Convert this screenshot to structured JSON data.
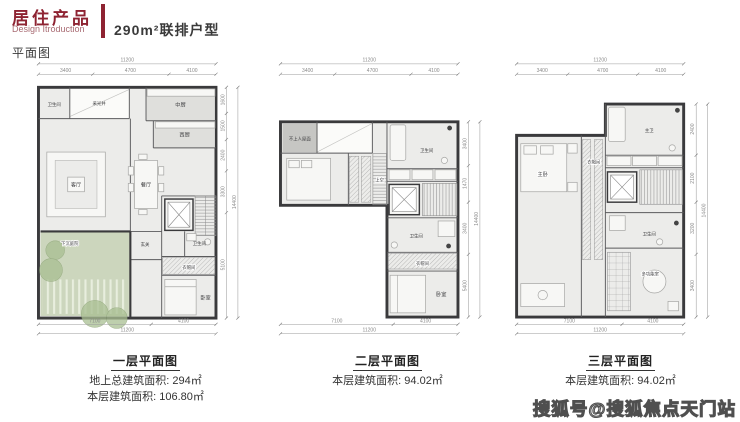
{
  "header": {
    "title_cn": "居住产品",
    "title_en": "Design Itroduction",
    "product": "290m²联排户型",
    "section": "平面图",
    "accent": "#8e2332"
  },
  "watermark": "搜狐号@搜狐焦点天门站",
  "floor1": {
    "caption": {
      "title": "一层平面图",
      "line1": "地上总建筑面积: 294㎡",
      "line2": "本层建筑面积: 106.80㎡"
    },
    "rooms": {
      "bath_top": "卫生间",
      "lightwell": "采光井",
      "kitchen_cn": "中厨",
      "kitchen_west": "西厨",
      "living": "客厅",
      "dining": "餐厅",
      "courtyard": "下沉庭院",
      "foyer": "玄关",
      "bath": "卫生间",
      "cloak": "衣帽间",
      "bedroom": "卧室"
    },
    "dims": {
      "top": {
        "total": "11200",
        "segs": [
          "3400",
          "4700",
          "4100"
        ]
      },
      "bottom": {
        "total": "11200",
        "segs": [
          "7100",
          "4100"
        ]
      },
      "right": {
        "total": "14400",
        "segs": [
          "1600",
          "1500",
          "2400",
          "3300",
          "5100"
        ]
      }
    }
  },
  "floor2": {
    "caption": {
      "title": "二层平面图",
      "line1": "本层建筑面积: 94.02㎡"
    },
    "rooms": {
      "roof": "不上人屋面",
      "void": "上空",
      "bath_top": "卫生间",
      "bath_mid": "卫生间",
      "cloak": "衣帽间",
      "bedroom": "卧室"
    },
    "dims": {
      "top": {
        "total": "11200",
        "segs": [
          "3400",
          "4700",
          "4100"
        ]
      },
      "bottom": {
        "total": "11200",
        "segs": [
          "7100",
          "4100"
        ]
      },
      "right": {
        "total": "14400",
        "segs": [
          "3400",
          "1470",
          "3400",
          "5400"
        ]
      }
    }
  },
  "floor3": {
    "caption": {
      "title": "三层平面图",
      "line1": "本层建筑面积: 94.02㎡"
    },
    "rooms": {
      "master_bath": "主卫",
      "master_bed": "主卧",
      "cloak": "衣帽间",
      "bath": "卫生间",
      "multi": "多功能室"
    },
    "dims": {
      "top": {
        "total": "11200",
        "segs": [
          "3400",
          "4700",
          "4100"
        ]
      },
      "bottom": {
        "total": "11200",
        "segs": [
          "7100",
          "4100"
        ]
      },
      "right": {
        "total": "14400",
        "segs": [
          "2400",
          "2100",
          "3200",
          "3400"
        ]
      }
    }
  }
}
